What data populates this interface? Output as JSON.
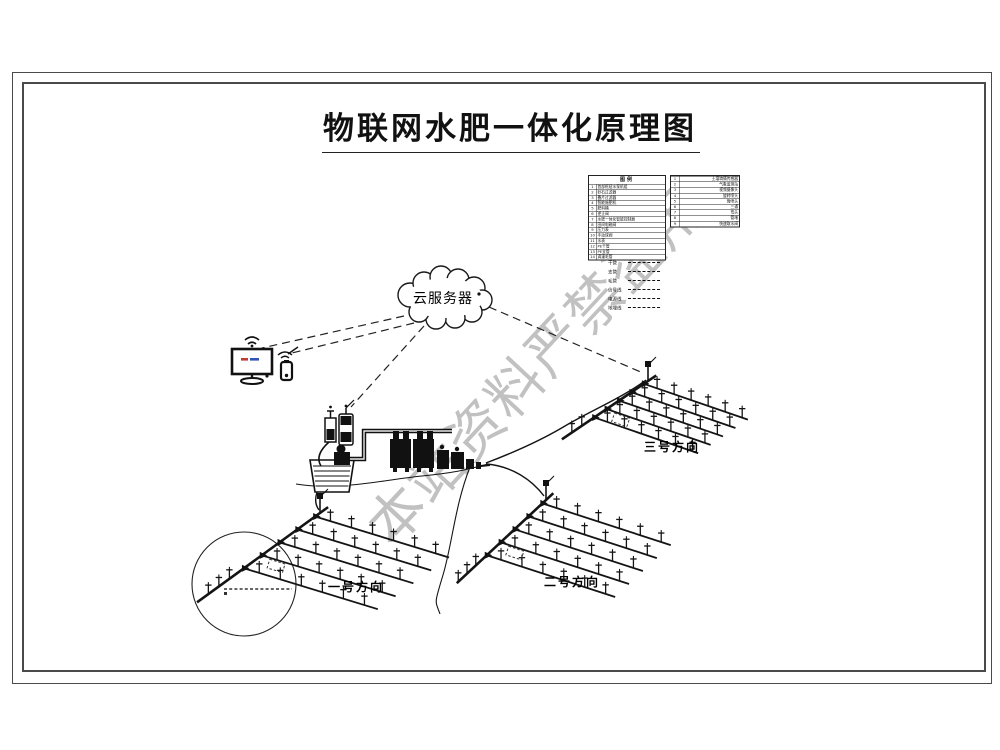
{
  "title": {
    "text": "物联网水肥一体化原理图"
  },
  "watermark": {
    "text": "本站资料严禁盗用",
    "color": "#8f8f8f"
  },
  "cloud": {
    "label": "云服务器"
  },
  "legend": {
    "title": "图例",
    "items": [
      {
        "no": "1",
        "name": "首部枢纽水泵机组"
      },
      {
        "no": "2",
        "name": "砂石过滤器"
      },
      {
        "no": "3",
        "name": "叠片过滤器"
      },
      {
        "no": "4",
        "name": "智能施肥机"
      },
      {
        "no": "5",
        "name": "肥料桶"
      },
      {
        "no": "6",
        "name": "逆止阀"
      },
      {
        "no": "7",
        "name": "水肥一体化智能控制器"
      },
      {
        "no": "8",
        "name": "田间电磁阀"
      },
      {
        "no": "9",
        "name": "压力表"
      },
      {
        "no": "10",
        "name": "手动球阀"
      },
      {
        "no": "11",
        "name": "水表"
      },
      {
        "no": "12",
        "name": "PE干管"
      },
      {
        "no": "13",
        "name": "PE支管"
      },
      {
        "no": "14",
        "name": "滴灌毛管"
      }
    ],
    "right_items": [
      {
        "no": "1",
        "name": "土壤墒情传感器"
      },
      {
        "no": "2",
        "name": "气象监测站"
      },
      {
        "no": "3",
        "name": "视频摄像头"
      },
      {
        "no": "4",
        "name": "旋转喷头"
      },
      {
        "no": "5",
        "name": "微喷头"
      },
      {
        "no": "6",
        "name": "三通"
      },
      {
        "no": "7",
        "name": "弯头"
      },
      {
        "no": "8",
        "name": "管堵"
      },
      {
        "no": "9",
        "name": "快速取水阀"
      }
    ],
    "line_samples": [
      "干管",
      "支管",
      "毛管",
      "信号线",
      "电源线",
      "地埋线"
    ]
  },
  "fields": [
    {
      "label": "一号方向"
    },
    {
      "label": "二号方向"
    },
    {
      "label": "三号方向"
    }
  ],
  "colors": {
    "line": "#141414",
    "screen_red": "#c23b32",
    "screen_blue": "#3453b8"
  }
}
